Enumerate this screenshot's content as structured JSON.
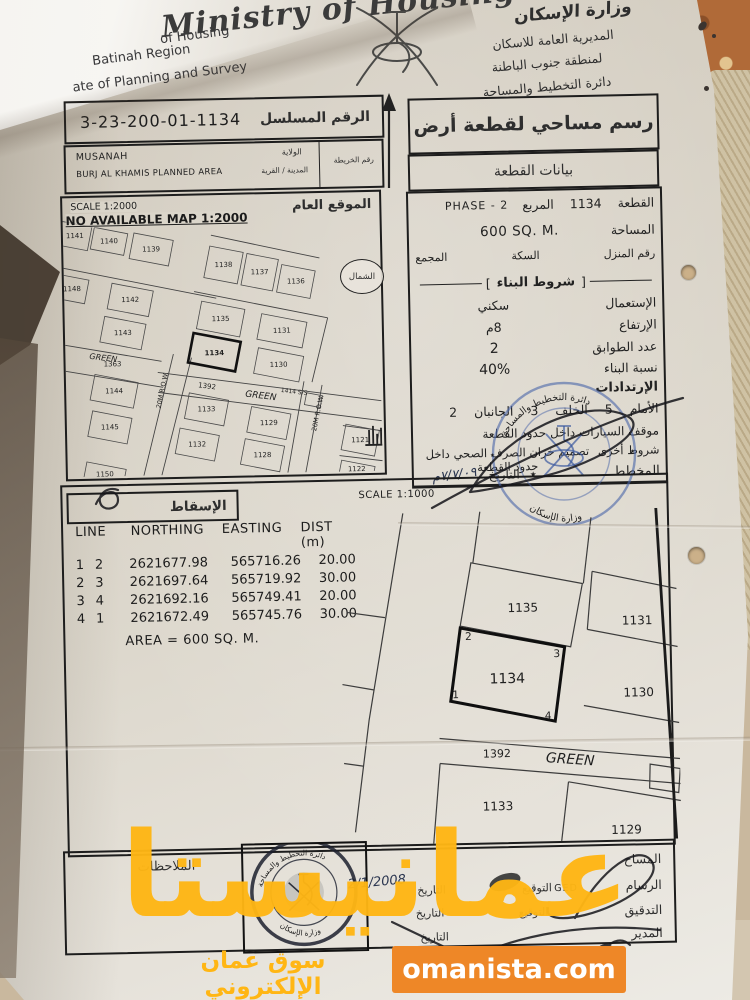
{
  "header": {
    "script_title": "Ministry of Housing",
    "english_lines": [
      "of Housing",
      "Batinah Region",
      "ate of Planning and Survey"
    ],
    "ministry_calligraphy": "وزارة الإسكان",
    "arabic_lines": [
      "المديرية العامة للاسكان",
      "لمنطقة جنوب الباطنة",
      "دائرة التخطيط والمساحة"
    ]
  },
  "serial": {
    "label": "الرقم المسلسل",
    "value": "3-23-200-01-1134"
  },
  "location": {
    "wilaya_label": "الولاية",
    "wilaya_value": "MUSANAH",
    "town_label": "المدينة / القرية",
    "town_value": "BURJ AL KHAMIS PLANNED AREA",
    "map_no_label": "رقم الخريطة"
  },
  "site_map": {
    "title": "الموقع العام",
    "scale": "SCALE 1:2000",
    "note": "NO AVAILABLE MAP 1:2000",
    "north_label": "الشمال",
    "green1": "GREEN",
    "green2": "GREEN",
    "row1": "20M R.O.W.",
    "row2": "20M R.O.W.",
    "plots": [
      "1141",
      "1140",
      "1139",
      "1138",
      "1137",
      "1136",
      "1148",
      "1142",
      "1143",
      "1363",
      "1144",
      "1135",
      "1134",
      "1131",
      "1130",
      "1392",
      "1133",
      "1129",
      "1145",
      "1132",
      "1128",
      "1121",
      "1150",
      "1122",
      "1414 S/S"
    ]
  },
  "survey": {
    "title": "رسم مساحي لقطعة أرض",
    "subtitle": "بيانات القطعة",
    "plot_label": "القطعة",
    "plot_value": "1134",
    "square_label": "المربع",
    "phase_value": "PHASE - 2",
    "area_label": "المساحة",
    "area_value": "600 SQ. M.",
    "house_label": "رقم المنزل",
    "street_label": "السكة",
    "complex_label": "المجمع",
    "conditions_title": "شروط البناء",
    "cond_open": "]",
    "cond_close": "[",
    "use_label": "الإستعمال",
    "use_value": "سكني",
    "height_label": "الإرتفاع",
    "height_value": "8م",
    "floors_label": "عدد الطوابق",
    "floors_value": "2",
    "ratio_label": "نسبة البناء",
    "ratio_value": "40%",
    "setbacks_label": "الإرتدادات",
    "setbacks_value": "الأمام 5 الخلف 3 الجانبان 2",
    "parking_note": "موقف السيارات داخل حدود القطعة",
    "other_label": "شروط أخرى",
    "other_value": "تصميم خزان الصرف الصحي داخل حدود القطعة",
    "planner_label": "المخطط",
    "date_label": "التاريخ",
    "date_value": "٧/٧/٠٩م",
    "star": "٭"
  },
  "projection": {
    "label": "الإسقاط",
    "scale": "SCALE 1:1000"
  },
  "coords": {
    "headers": [
      "LINE",
      "NORTHING",
      "EASTING",
      "DIST (m)"
    ],
    "rows": [
      [
        "1",
        "2",
        "2621677.98",
        "565716.26",
        "20.00"
      ],
      [
        "2",
        "3",
        "2621697.64",
        "565719.92",
        "30.00"
      ],
      [
        "3",
        "4",
        "2621692.16",
        "565749.41",
        "20.00"
      ],
      [
        "4",
        "1",
        "2621672.49",
        "565745.76",
        "30.00"
      ]
    ],
    "area_note": "AREA = 600 SQ. M."
  },
  "detail_map": {
    "plots": {
      "p1135": "1135",
      "p1134": "1134",
      "p1131": "1131",
      "p1130": "1130",
      "p1392": "1392",
      "green": "GREEN",
      "p1133": "1133",
      "p1129": "1129"
    },
    "corners": [
      "1",
      "2",
      "3",
      "4"
    ]
  },
  "stamps": {
    "blue_top": "دائرة التخطيط والمساحة",
    "blue_bottom": "وزارة الإسكان",
    "dark_top": "دائرة التخطيط والمساحة",
    "dark_bottom": "وزارة الإسكان",
    "star": "٭"
  },
  "notes": {
    "label": "الملاحظات"
  },
  "signatures": {
    "surveyor_label": "المساح",
    "draftsman_label": "الرسام",
    "check_label": "التدقيق",
    "manager_label": "المدير",
    "sign_label": "التوقيع",
    "sign_label2": "التوقيع",
    "date_label1": "التاريخ",
    "date_label2": "التاريخ",
    "date_label3": "التاريخ",
    "ged": "GED",
    "handwritten_date": "2/1/2008"
  },
  "watermark": {
    "main": "عمانيستا",
    "tagline": "سوق عمان الإلكتروني",
    "site": "omanista.com",
    "color": "#FFB614",
    "box_color": "#EE8727"
  }
}
